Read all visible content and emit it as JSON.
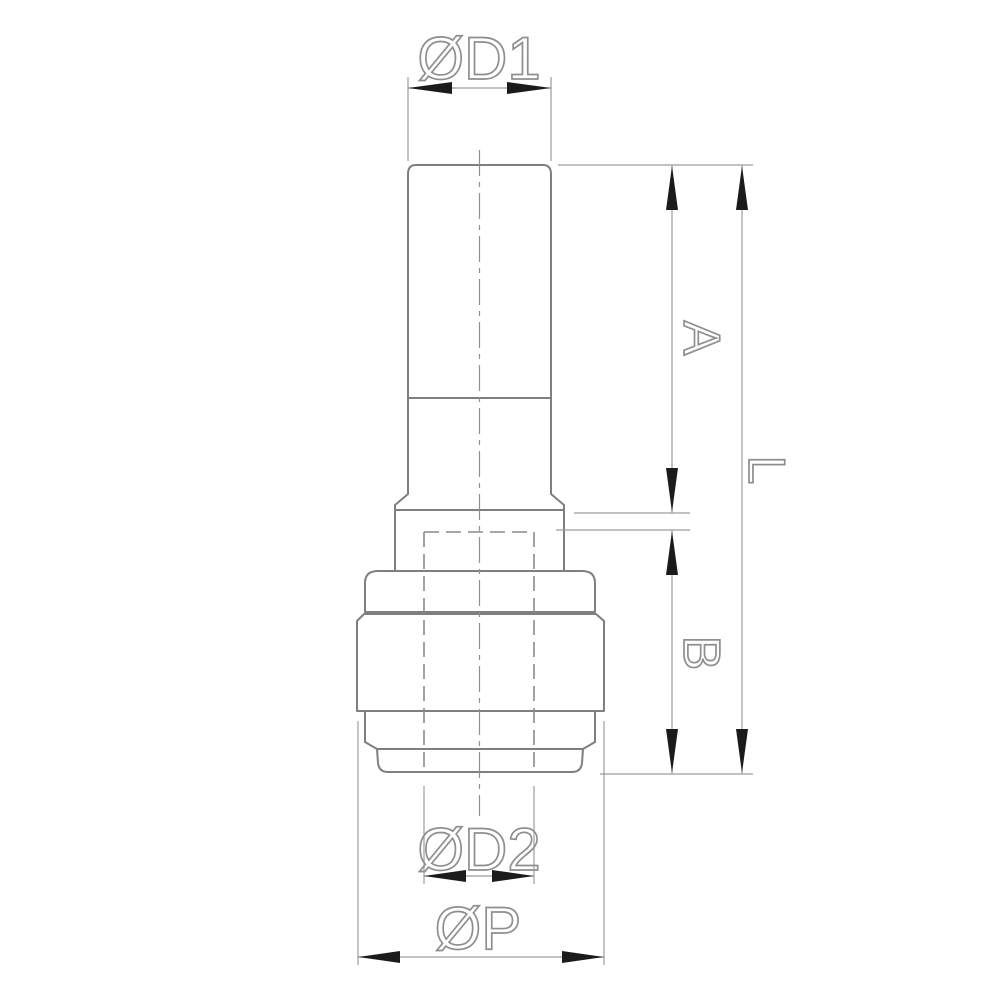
{
  "drawing": {
    "labels": {
      "d1": "ØD1",
      "a": "A",
      "l": "L",
      "b": "B",
      "d2": "ØD2",
      "p": "ØP"
    },
    "colors": {
      "background": "#ffffff",
      "outline": "#7f7f7f",
      "hidden_line": "#8a8a8a",
      "dimension_line": "#9c9c9c",
      "arrowhead": "#1b1b1b",
      "label_text": "#8f8f8f"
    }
  }
}
